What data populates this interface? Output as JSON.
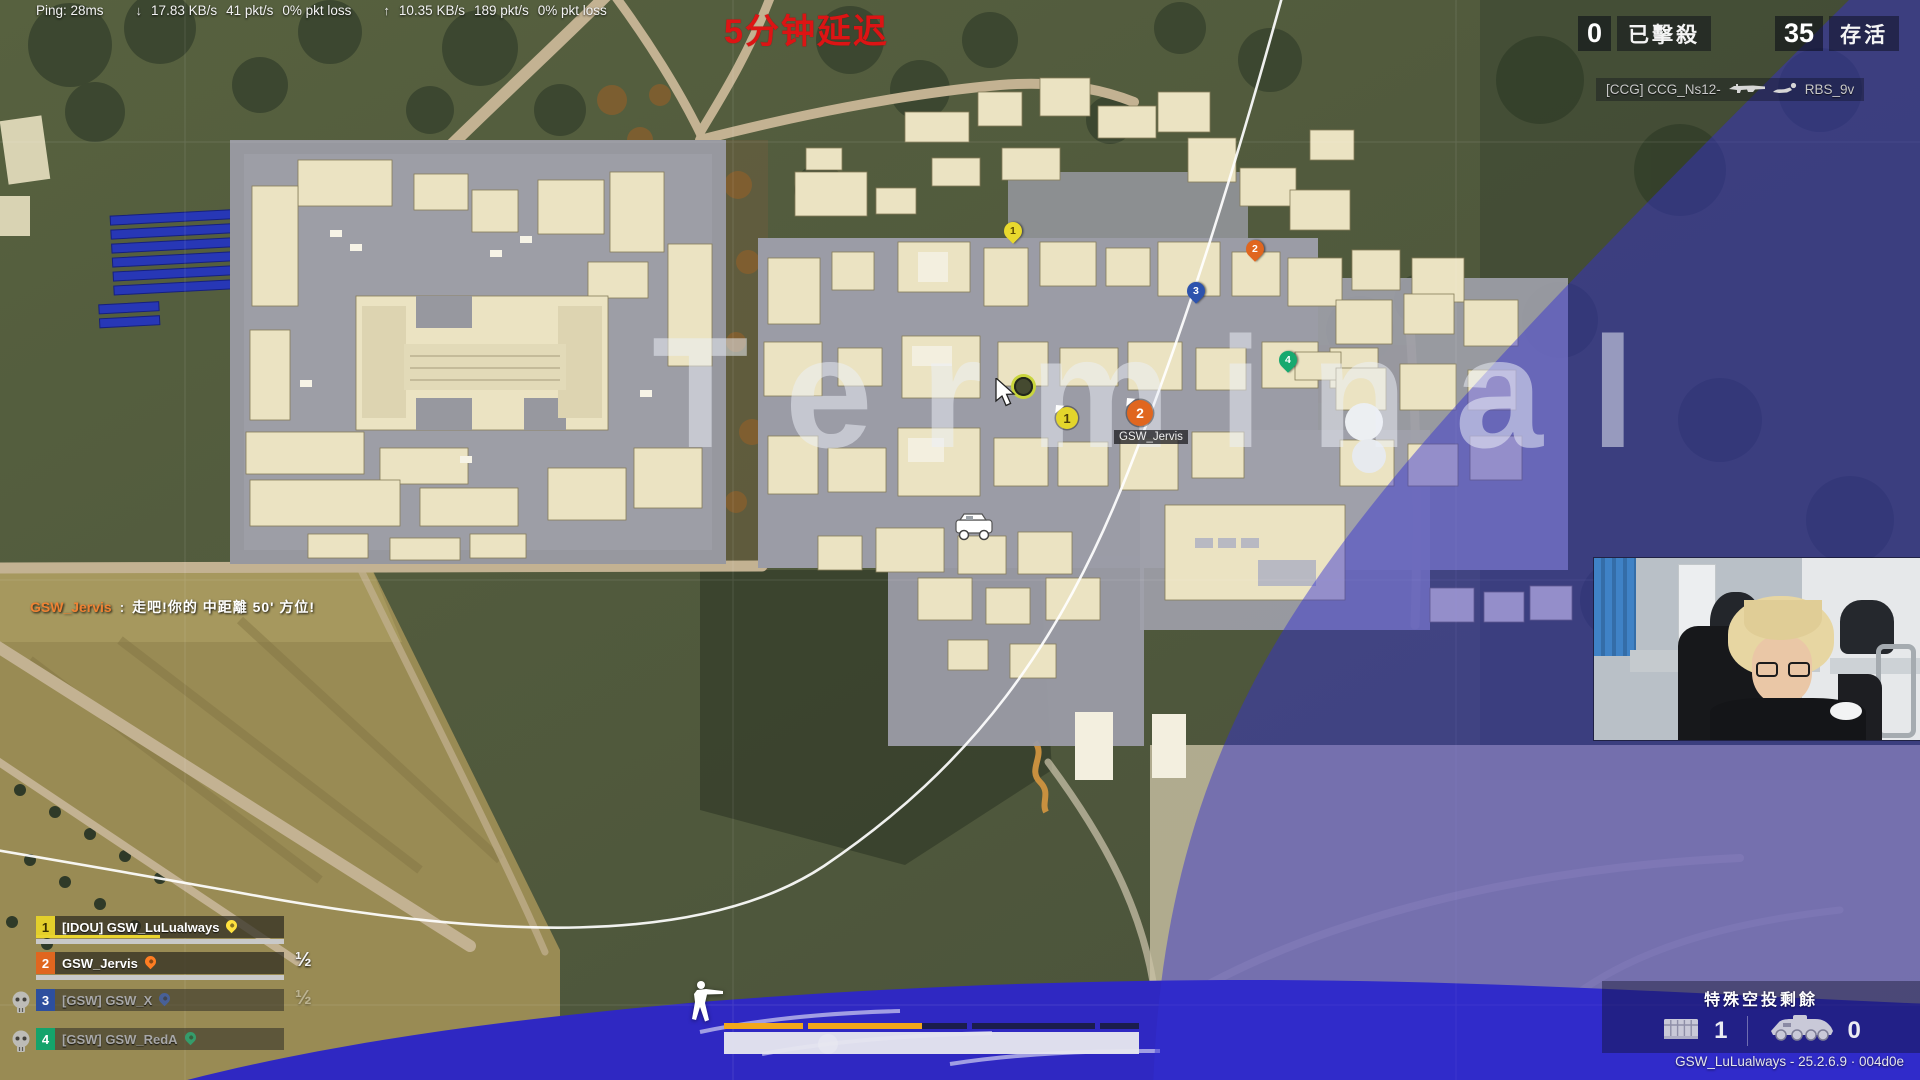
{
  "network": {
    "ping": "Ping: 28ms",
    "down_icon": "↓",
    "down_rate": "17.83 KB/s",
    "down_pkt": "41 pkt/s",
    "down_loss": "0% pkt loss",
    "up_icon": "↑",
    "up_rate": "10.35 KB/s",
    "up_pkt": "189 pkt/s",
    "up_loss": "0% pkt loss"
  },
  "delay_banner": "5分钟延迟",
  "scoreboard": {
    "kills_value": "0",
    "kills_label": "已擊殺",
    "alive_value": "35",
    "alive_label": "存活"
  },
  "killfeed": {
    "attacker": "[CCG] CCG_Ns12-",
    "victim": "RBS_9v"
  },
  "map": {
    "region_label": "Terminal",
    "name_tag": "GSW_Jervis",
    "player_markers": [
      {
        "num": "1",
        "color": "#e3d52c"
      },
      {
        "num": "2",
        "color": "#e0661f"
      }
    ],
    "pins": [
      {
        "num": "1",
        "color": "#e8d92e"
      },
      {
        "num": "2",
        "color": "#e0661f"
      },
      {
        "num": "3",
        "color": "#2d53ad"
      },
      {
        "num": "4",
        "color": "#17a96f"
      }
    ]
  },
  "chat": {
    "name": "GSW_Jervis",
    "separator": ":",
    "message": "走吧!你的 中距離 50' 方位!"
  },
  "team": {
    "rows": [
      {
        "num": "1",
        "name": "[IDOU] GSW_LuLualways",
        "color": "#e3cf2b",
        "dead": false,
        "boost_fill": 0.5,
        "health_fill": 1
      },
      {
        "num": "2",
        "name": "GSW_Jervis",
        "color": "#e0661f",
        "dead": false,
        "health_fill": 1
      },
      {
        "num": "3",
        "name": "[GSW] GSW_X",
        "color": "#2d4f9e",
        "dead": true
      },
      {
        "num": "4",
        "name": "[GSW] GSW_RedA",
        "color": "#14a36b",
        "dead": true
      }
    ],
    "fraction_badge": "½"
  },
  "hud": {
    "boost_segments": [
      {
        "fill": 1
      },
      {
        "fill": 0.72
      },
      {
        "fill": 0
      },
      {
        "fill": 0
      }
    ],
    "health_fill": 1
  },
  "airdrop": {
    "title": "特殊空投剩餘",
    "crate_count": "1",
    "vehicle_count": "0"
  },
  "watermark": "GSW_LuLualways - 25.2.6.9 · 004d0e",
  "colors": {
    "zone_blue": "#342ed2",
    "boost_orange": "#f2a71b",
    "delay_red": "#dd1414",
    "chat_orange": "#ef8334"
  }
}
